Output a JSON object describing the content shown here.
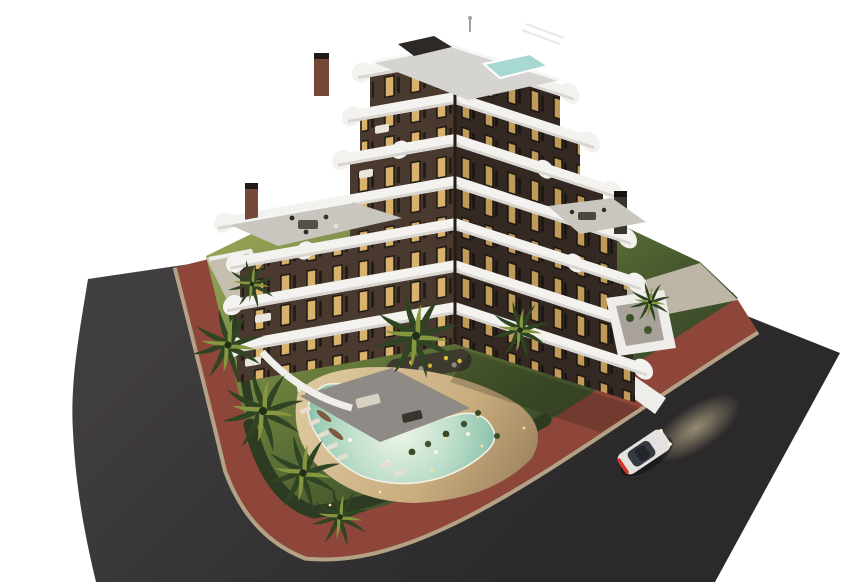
{
  "scene": {
    "description": "Aerial dusk 3D architectural rendering of a stepped modern apartment building with curved white balcony bands, landscaped garden, free-form glowing pool, palm trees, red perimeter sidewalk, corner asphalt road and a white car with headlights on",
    "objects": [
      "apartment-building",
      "balcony-bands",
      "rooftop-terrace",
      "rooftop-plunge-pool",
      "pergola",
      "chimneys",
      "roof-terrace-left",
      "roof-terrace-right",
      "garden-lawn",
      "free-form-pool",
      "pool-deck",
      "sun-loungers",
      "closed-parasols",
      "shrub-lights",
      "flower-bed",
      "palm-trees",
      "perimeter-hedge",
      "perimeter-walls",
      "red-sidewalk",
      "asphalt-road",
      "white-car"
    ]
  },
  "colors": {
    "background": "#ffffff",
    "asphalt": "#343132",
    "asphaltLight": "#454243",
    "sidewalk": "#8d4639",
    "curb": "#b3a286",
    "lawnLight": "#93a155",
    "lawnDark": "#35452a",
    "hedge": "#2c3b22",
    "deckSand": "#d7c094",
    "poolShallow": "#eef5e8",
    "poolDeep": "#6fa896",
    "facadeLeft": "#4a392e",
    "facadeRight": "#342822",
    "windowGlow": "#d9b26e",
    "slabWhite": "#f3f2ef",
    "slabShade": "#d9d6d1",
    "roofDeck": "#d6d4d0",
    "terraceDeck": "#c9c6c0",
    "wallWhite": "#eeedea",
    "pavement": "#c6bfb0",
    "patio": "#8f8a85",
    "chimneyBrick": "#74493a",
    "chimneyDark": "#3a332e",
    "palmDark": "#2f4422",
    "palmLight": "#86973f",
    "trunk": "#6b5940",
    "umbrella": "#7c5b3e",
    "lounger": "#e6dfcd",
    "carBody": "#e3e2df",
    "carGlass": "#363b41",
    "taillight": "#d63226",
    "headlightGlow": "#f2dfae",
    "lightDot": "#ffdf9a"
  }
}
